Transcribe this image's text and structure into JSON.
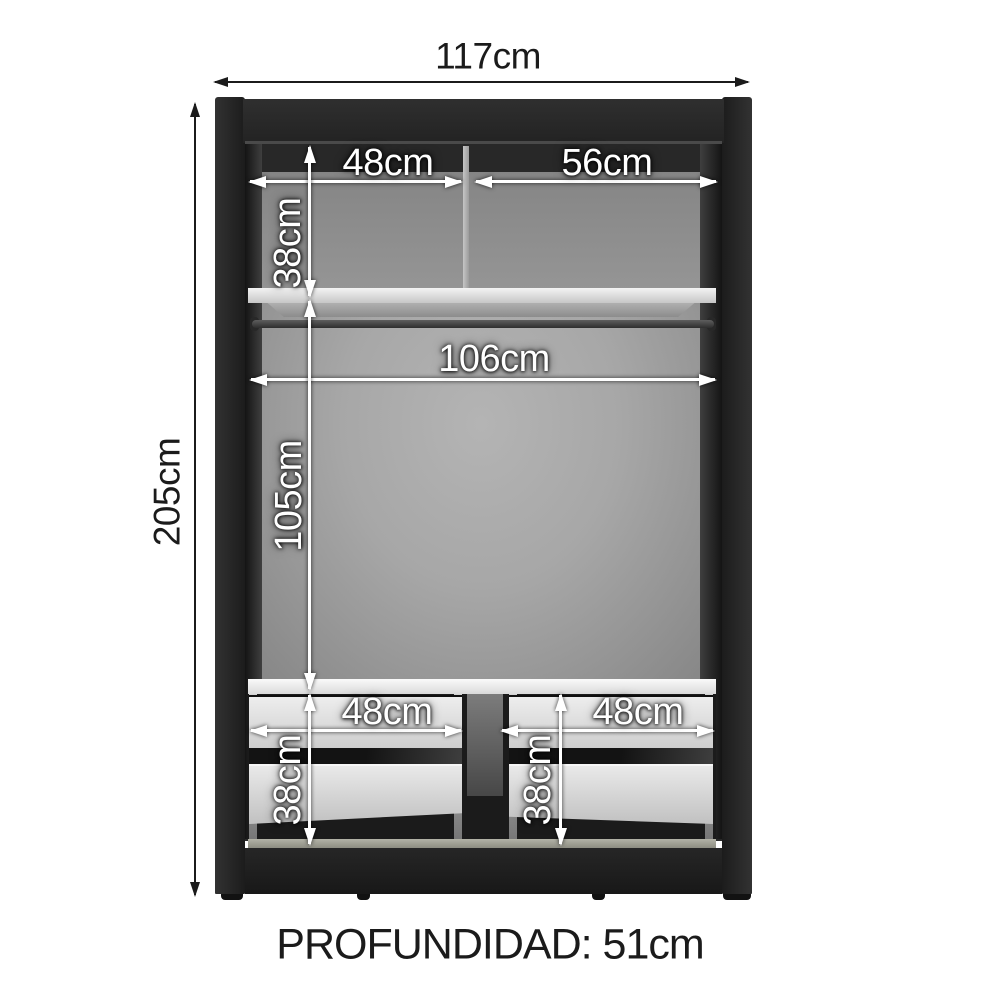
{
  "figure": {
    "type": "furniture interior dimension diagram",
    "subject": "two-section wardrobe with top shelf, hanging rod and four drawers"
  },
  "labels": {
    "total_width": "117cm",
    "total_height": "205cm",
    "depth": "PROFUNDIDAD: 51cm",
    "top_shelf_left_width": "48cm",
    "top_shelf_right_width": "56cm",
    "top_compartment_height": "38cm",
    "hanging_rod_width": "106cm",
    "hanging_space_height": "105cm",
    "left_drawer_width": "48cm",
    "right_drawer_width": "48cm",
    "left_drawer_height": "38cm",
    "right_drawer_height": "38cm"
  },
  "colors": {
    "background": "#ffffff",
    "frame": "#242424",
    "back_wall": "#9a9a9a",
    "shelf": "#e9e9e9",
    "drawer_front": "#dcdcdc",
    "floor_strip": "#a8a89c",
    "inner_dimension_text": "#ffffff",
    "outer_dimension_text": "#1b1b1b"
  }
}
